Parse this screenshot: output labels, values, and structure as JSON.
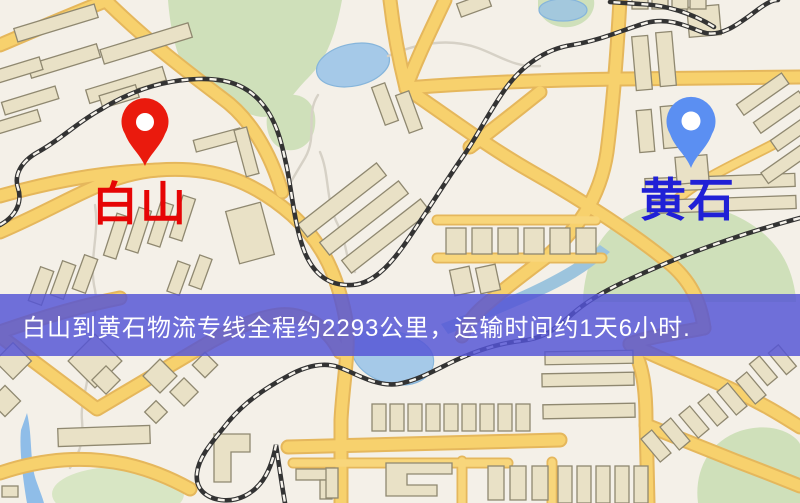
{
  "banner": {
    "text": "白山到黄石物流专线全程约2293公里，运输时间约1天6小时.",
    "background_color": "#5454d6",
    "text_color": "#ffffff"
  },
  "markers": {
    "origin": {
      "label": "白山",
      "pin_color": "#ea1a0d",
      "label_color": "#e60505"
    },
    "destination": {
      "label": "黄石",
      "pin_color": "#5b8ff2",
      "label_color": "#2020d6"
    }
  },
  "route_info": {
    "origin": "白山",
    "destination": "黄石",
    "distance_text": "约2293公里",
    "duration_text": "约1天6小时"
  },
  "map_palette": {
    "background": "#f4f0e8",
    "road_fill": "#f7d16d",
    "road_casing": "#e5b75c",
    "water": "#a5c9e8",
    "park": "#cfe0ba",
    "building": "#e9e1c6",
    "building_outline": "#8f8870",
    "railway": "#333333"
  }
}
